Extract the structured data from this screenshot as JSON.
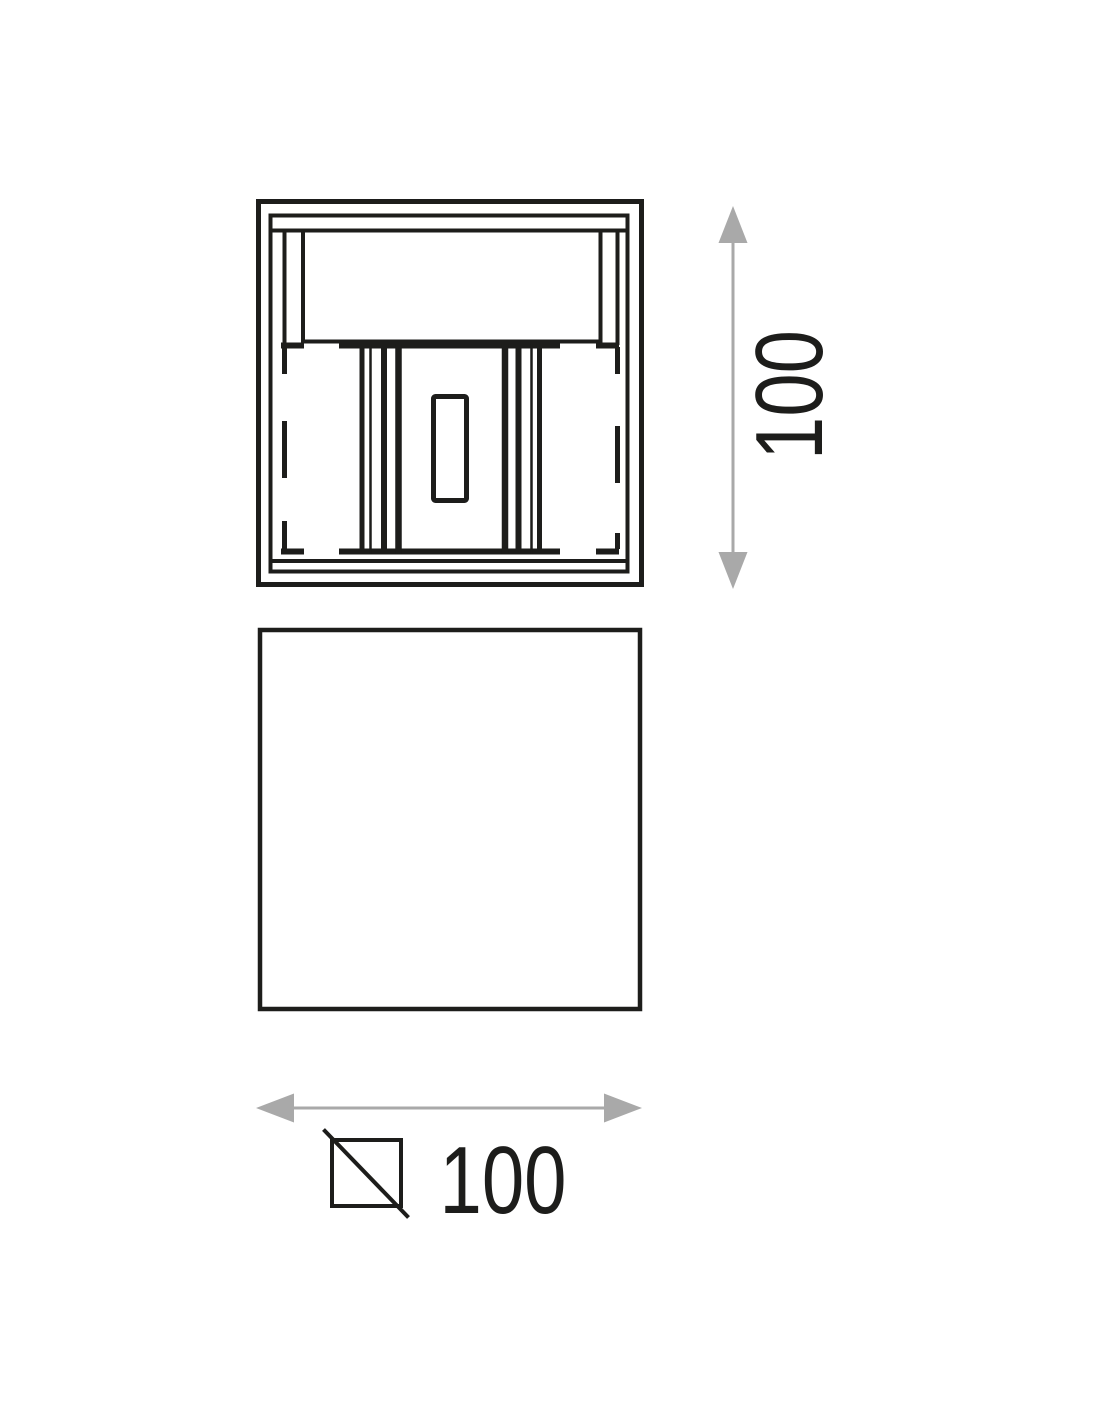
{
  "dimensions": {
    "height": {
      "value": "100"
    },
    "width": {
      "value": "100"
    }
  },
  "symbols": {
    "square_section": "square-with-diagonal"
  },
  "colors": {
    "line": "#1d1d1b",
    "dimension_arrow": "#a9a9a9",
    "background": "#ffffff"
  }
}
